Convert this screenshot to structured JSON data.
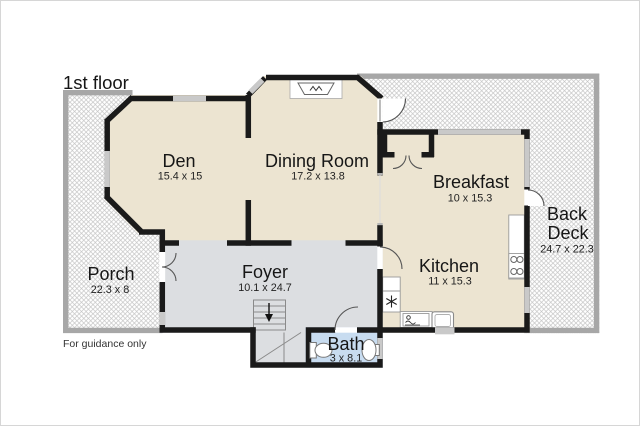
{
  "plan": {
    "title": "1st floor",
    "disclaimer": "For guidance only",
    "rooms": {
      "den": {
        "name": "Den",
        "dims": "15.4 x 15"
      },
      "dining": {
        "name": "Dining Room",
        "dims": "17.2 x 13.8"
      },
      "breakfast": {
        "name": "Breakfast",
        "dims": "10 x 15.3"
      },
      "kitchen": {
        "name": "Kitchen",
        "dims": "11 x 15.3"
      },
      "foyer": {
        "name": "Foyer",
        "dims": "10.1 x 24.7"
      },
      "bath": {
        "name": "Bath",
        "dims": "3 x 8.1"
      },
      "porch": {
        "name": "Porch",
        "dims": "22.3 x 8"
      },
      "back_deck": {
        "line1": "Back",
        "line2": "Deck",
        "dims": "24.7 x 22.3"
      }
    },
    "icons": [
      "fireplace-icon",
      "stove-icon",
      "refrigerator-icon",
      "dishwasher-icon",
      "kitchen-sink-icon",
      "toilet-icon",
      "bath-sink-icon",
      "stairs-down-arrow-icon"
    ],
    "colors": {
      "room_floor": "#ece4d1",
      "foyer_floor": "#dcdee1",
      "bath_floor": "#c8dcf0",
      "wall": "#1a1a1a",
      "deck_border": "#a7a7a7",
      "window": "#c9c9c9"
    }
  }
}
